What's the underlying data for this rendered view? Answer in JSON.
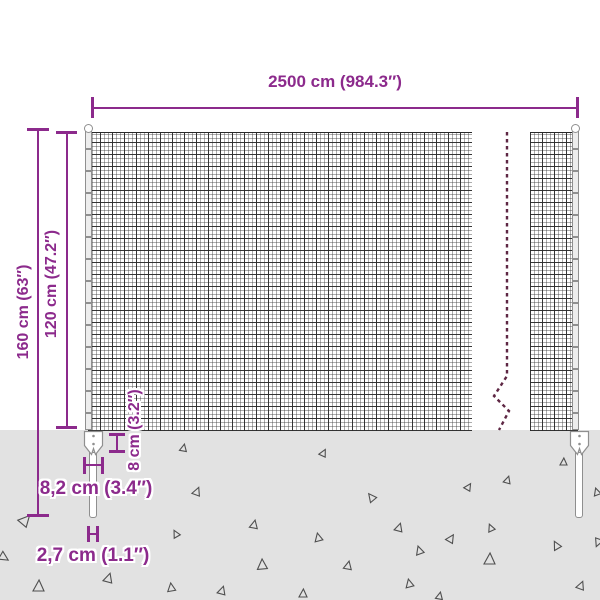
{
  "diagram": {
    "subject": "wire-mesh-fence-dimension-diagram"
  },
  "dimensions": {
    "total_width": {
      "label": "2500 cm (984.3″)",
      "cm": "2500 cm",
      "inch": "984.3″"
    },
    "total_height": {
      "label": "160 cm (63″)",
      "cm": "160 cm",
      "inch": "63″"
    },
    "mesh_height": {
      "label": "120 cm (47.2″)",
      "cm": "120 cm",
      "inch": "47.2″"
    },
    "anchor_height": {
      "label": "8 cm (3.2″)",
      "cm": "8 cm",
      "inch": "3.2″"
    },
    "anchor_width": {
      "label": "8,2 cm (3.4″)",
      "cm": "8,2 cm",
      "inch": "3.4″"
    },
    "spike_width": {
      "label": "2,7 cm (1.1″)",
      "cm": "2,7 cm",
      "inch": "1.1″"
    }
  },
  "colors": {
    "accent": "#8c2a8c",
    "dashed_line": "#5e2744",
    "ground": "#e2e2e2",
    "mesh_line": "#3c3c3c",
    "hardware_outline": "#8f8f8f",
    "background": "#ffffff"
  },
  "ground": {
    "triangles": [
      [
        20,
        514,
        11,
        40
      ],
      [
        33,
        580,
        11,
        0
      ],
      [
        104,
        573,
        9,
        15
      ],
      [
        167,
        583,
        8,
        -10
      ],
      [
        180,
        444,
        7,
        10
      ],
      [
        193,
        487,
        8,
        20
      ],
      [
        172,
        530,
        7,
        -30
      ],
      [
        250,
        520,
        8,
        10
      ],
      [
        257,
        559,
        10,
        355
      ],
      [
        218,
        586,
        8,
        15
      ],
      [
        299,
        589,
        8,
        0
      ],
      [
        320,
        449,
        7,
        25
      ],
      [
        314,
        533,
        8,
        -15
      ],
      [
        344,
        561,
        8,
        10
      ],
      [
        367,
        493,
        8,
        -40
      ],
      [
        395,
        523,
        8,
        15
      ],
      [
        415,
        546,
        8,
        -20
      ],
      [
        447,
        534,
        8,
        30
      ],
      [
        465,
        483,
        7,
        30
      ],
      [
        487,
        524,
        7,
        -25
      ],
      [
        484,
        553,
        11,
        0
      ],
      [
        504,
        476,
        7,
        15
      ],
      [
        552,
        541,
        8,
        -30
      ],
      [
        560,
        458,
        7,
        0
      ],
      [
        577,
        581,
        8,
        20
      ],
      [
        405,
        579,
        8,
        -15
      ],
      [
        436,
        592,
        7,
        10
      ],
      [
        593,
        488,
        7,
        -20
      ],
      [
        594,
        539,
        8,
        200
      ],
      [
        0,
        553,
        9,
        120
      ]
    ]
  }
}
